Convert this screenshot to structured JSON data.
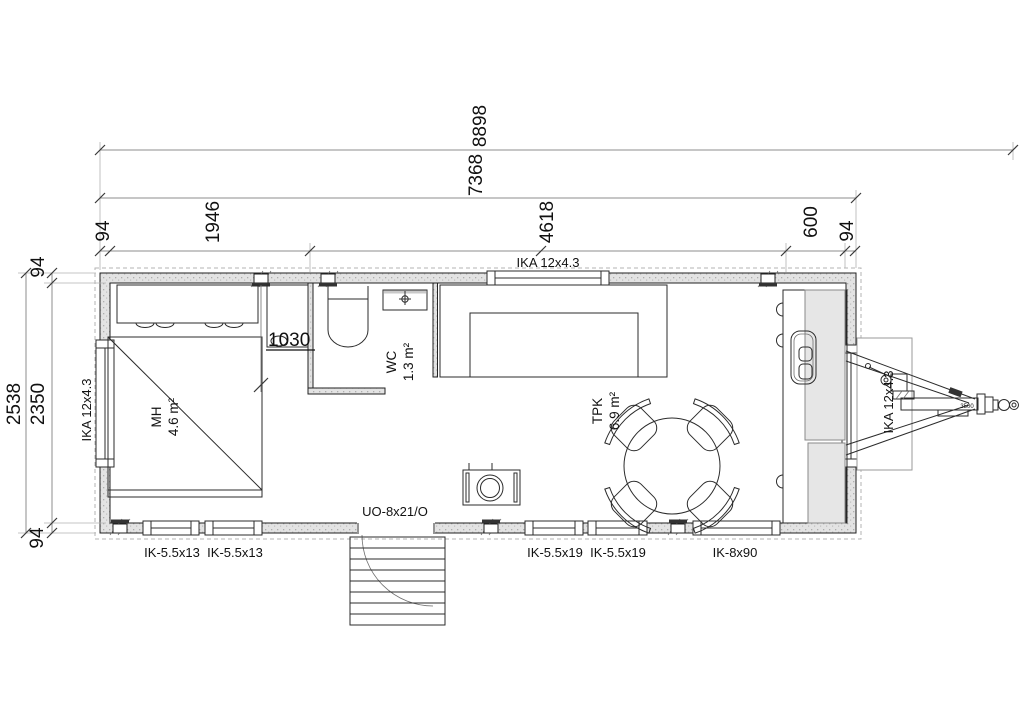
{
  "drawing": {
    "type": "floor-plan",
    "dims": {
      "total_length": "8898",
      "body_length": "7368",
      "seg_wall_left": "94",
      "seg_bedroom": "1946",
      "seg_living": "4618",
      "seg_kitchen": "600",
      "seg_wall_right": "94",
      "height_total": "2538",
      "height_inner": "2350",
      "wall_top": "94",
      "wall_bottom": "94",
      "opening_width": "1030",
      "coupler_rating": "3500"
    },
    "rooms": {
      "bedroom": {
        "code": "MH",
        "area": "4.6 m²"
      },
      "wc": {
        "code": "WC",
        "area": "1.3 m²"
      },
      "living": {
        "code": "TPK",
        "area": "6.9 m²"
      }
    },
    "openings": {
      "window_left": "IKA 12x4.3",
      "window_top": "IKA 12x4.3",
      "window_right": "IKA 12x4.3",
      "door": "UO-8x21/O",
      "bottom_window_1": "IK-5.5x13",
      "bottom_window_2": "IK-5.5x13",
      "bottom_window_3": "IK-5.5x19",
      "bottom_window_4": "IK-5.5x19",
      "bottom_window_5": "IK-8x90"
    },
    "colors": {
      "line": "#2b2b2b",
      "wall_fill": "#e3e3e3",
      "dim_line": "#8c8c8c",
      "background": "#ffffff"
    }
  }
}
